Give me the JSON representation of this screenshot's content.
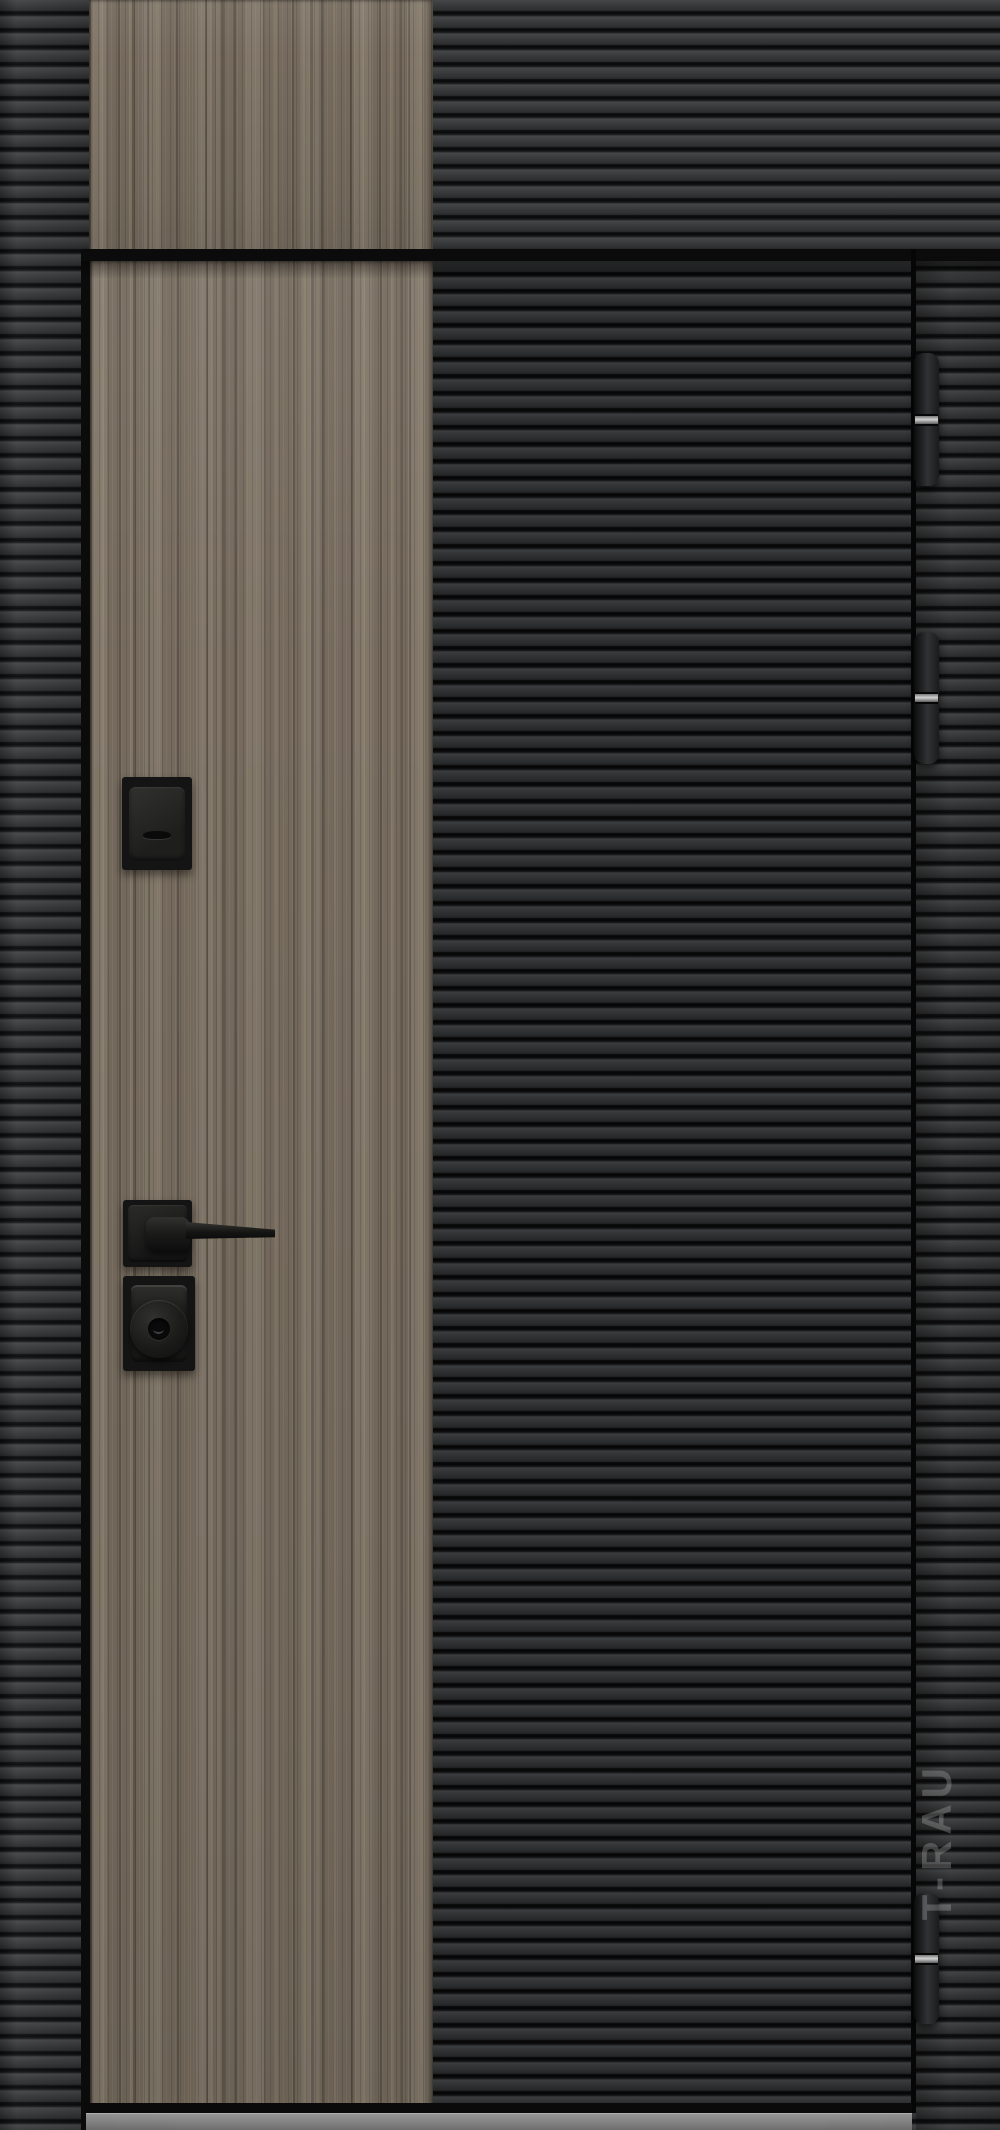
{
  "scene": {
    "type": "product-photo",
    "subject": "Front entrance door: dark horizontally-fluted panels with a full-height vertical wood accent stripe, black square-rose hardware, three barrel hinges on the right, metal threshold at the bottom",
    "watermark_text": "T-RAU"
  },
  "colors": {
    "wall_rib_face": "#3c3d3e",
    "wall_rib_groove": "#0a0a0b",
    "door_rib_face": "#333435",
    "door_rib_groove": "#070708",
    "wood_base": "#7c7163",
    "wood_streak_dark": "#5e5749",
    "wood_streak_light": "#8c816d",
    "frame_black": "#0b0b0c",
    "hinge_body": "#28292b",
    "hinge_pin_band": "#d0d0d0",
    "hardware_black": "#141414",
    "threshold_top": "#979797",
    "threshold_bottom": "#6d6d6d",
    "watermark_gray": "#bdbdbd"
  },
  "hardware": {
    "hinge_count": 3
  }
}
